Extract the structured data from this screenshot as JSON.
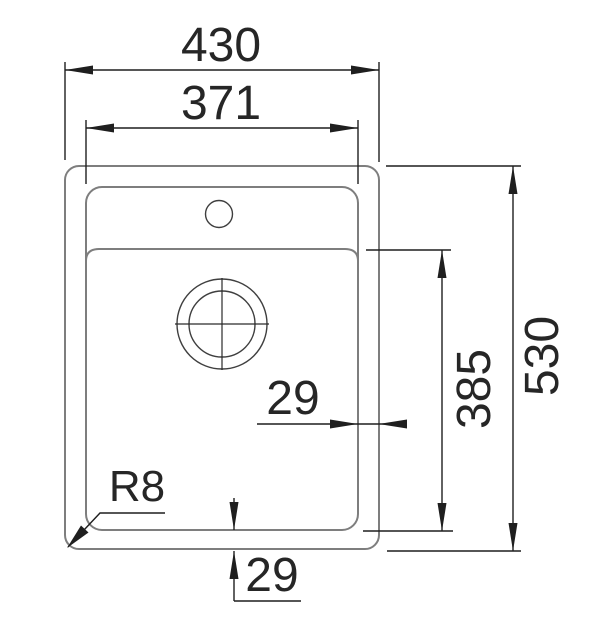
{
  "drawing": {
    "type": "technical-dimension-drawing",
    "subject": "Kitchen sink top view with faucet hole and drain"
  },
  "labels": {
    "overall_width": "430",
    "inner_width": "371",
    "overall_depth": "530",
    "bowl_depth": "385",
    "side_rim_offset": "29",
    "bottom_rim_offset": "29",
    "corner_radius": "R8"
  },
  "colors": {
    "sink_outline": "#7e7e7e",
    "detail_lines": "#3f3f3f",
    "dimension_lines": "#1f1f1f",
    "text": "#262626",
    "background": "#ffffff"
  }
}
